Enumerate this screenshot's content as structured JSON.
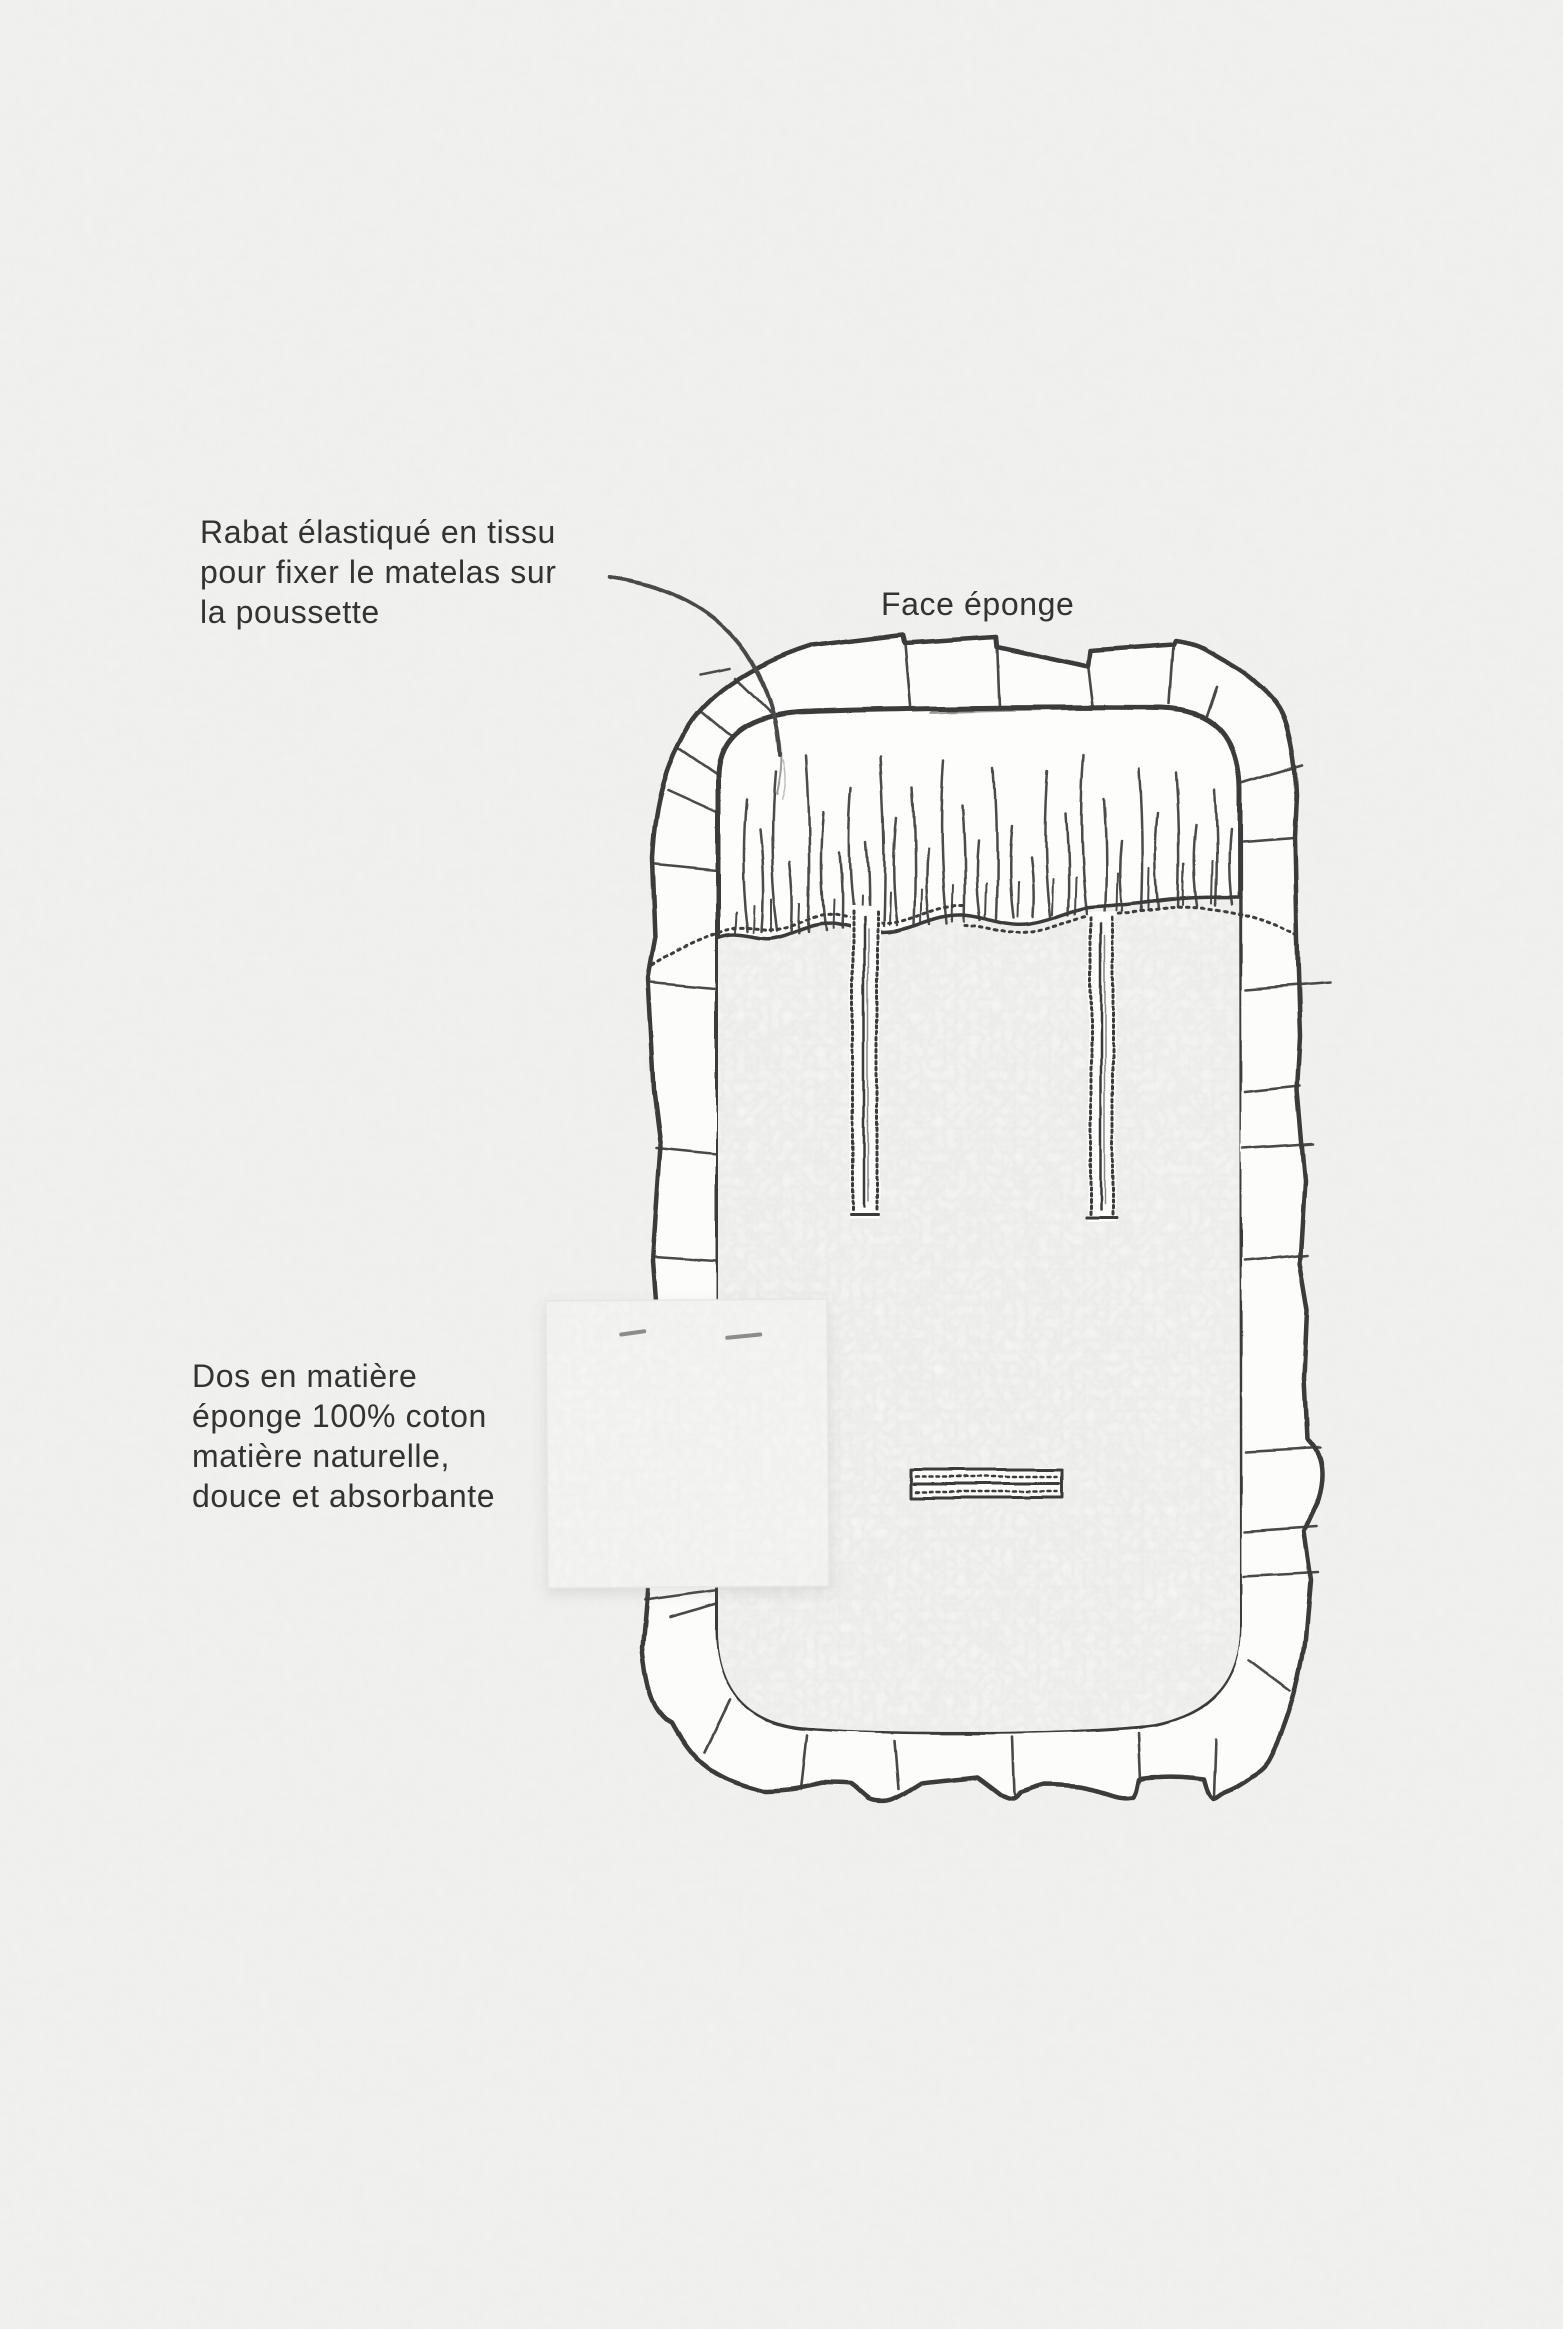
{
  "canvas": {
    "width": 1563,
    "height": 2329,
    "background_color": "#f1f1ef",
    "ink_color": "#3a3a3a",
    "text_color": "#333333",
    "paper_color": "#fcfcfb"
  },
  "annotations": {
    "rabat": {
      "lines": [
        "Rabat élastiqué en tissu",
        "pour fixer le matelas sur",
        "la poussette"
      ]
    },
    "face": {
      "label": "Face éponge"
    },
    "dos": {
      "lines": [
        "Dos en matière",
        "éponge 100% coton",
        "matière naturelle,",
        "douce et absorbante"
      ]
    }
  },
  "illustration": {
    "subject": "stroller-mattress-diagram",
    "parts": [
      "ruffle-border",
      "elastic-fabric-flap",
      "gather-stitch-line",
      "terry-texture-panel",
      "strap-slot-left",
      "strap-slot-right",
      "buckle-slot",
      "fabric-swatch",
      "staple-marks",
      "leader-line"
    ]
  }
}
